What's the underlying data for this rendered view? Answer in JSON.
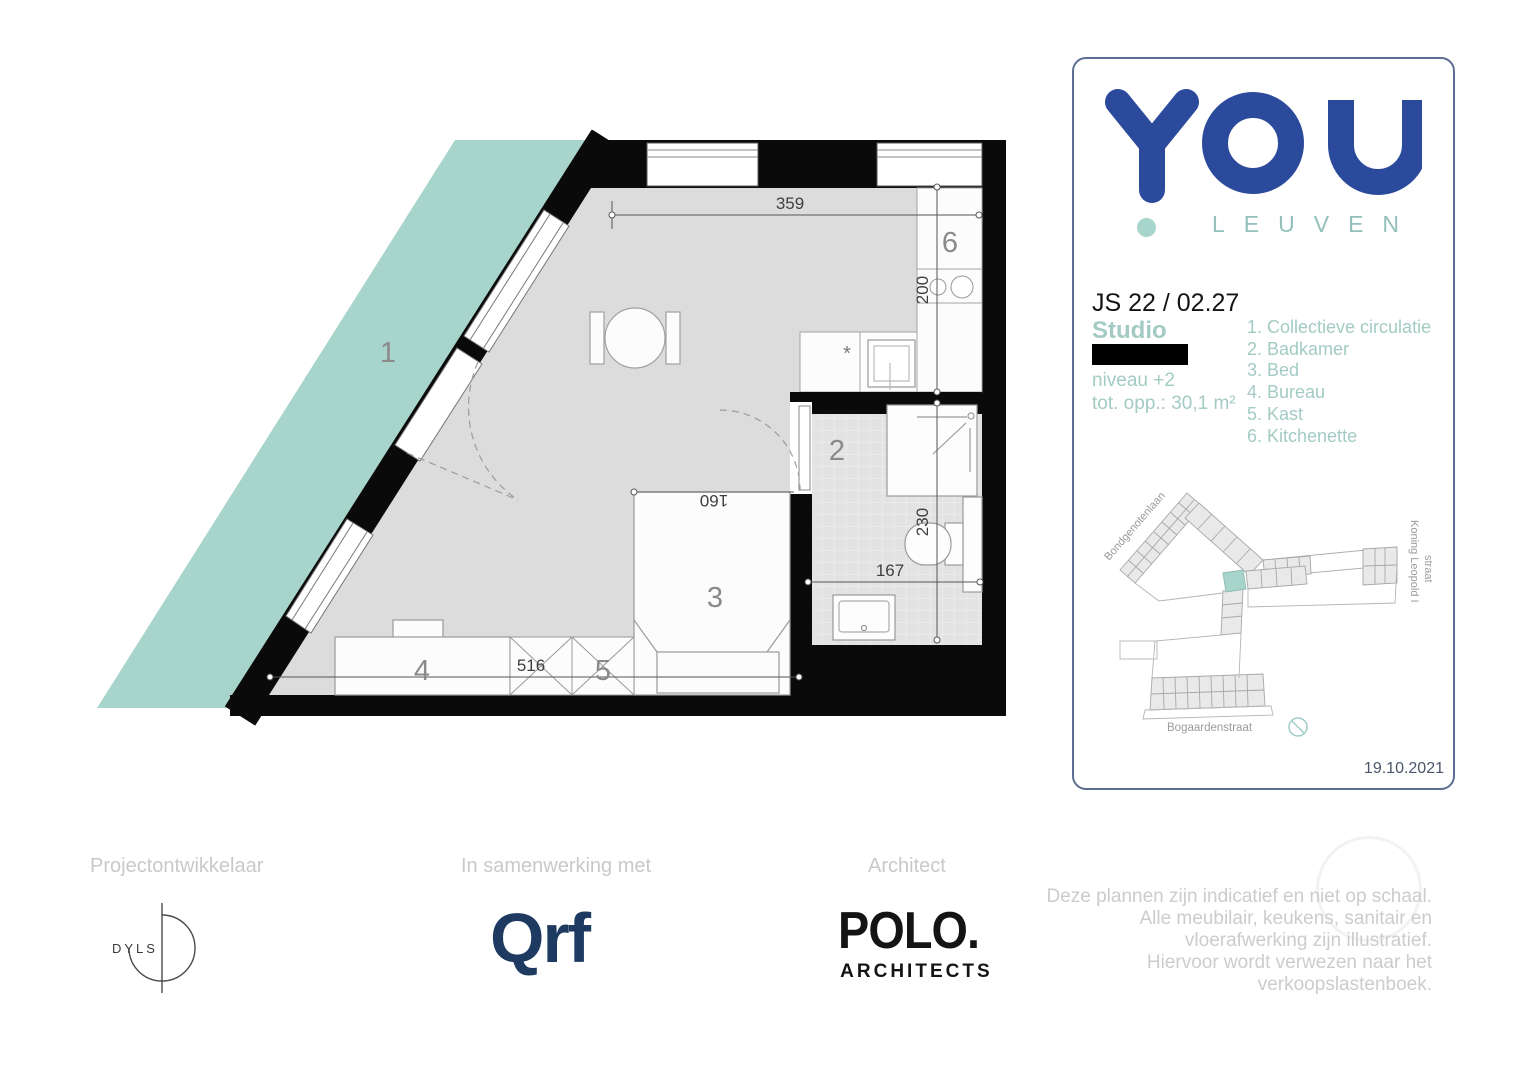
{
  "plan": {
    "rooms": {
      "circulation": "1",
      "bathroom": "2",
      "bed": "3",
      "bureau": "4",
      "kast": "5",
      "kitchenette": "6"
    },
    "dims": {
      "top": "359",
      "kitchen": "200",
      "bed": "160",
      "bath_v": "230",
      "bath_h": "167",
      "bottom": "516"
    },
    "kitchen_marker": "*",
    "colors": {
      "wall": "#0a0a0a",
      "floor": "#dcdcdc",
      "tile": "#e3e3e3",
      "circulation": "#a7d4cb"
    }
  },
  "card": {
    "logo": {
      "text": "YOU",
      "subtext": "LEUVEN",
      "blue": "#2b4a9c",
      "teal": "#a7d4cb"
    },
    "unit_code": "JS 22 / 02.27",
    "unit_type": "Studio",
    "level": "niveau +2",
    "area": "tot. opp.: 30,1 m²",
    "legend": [
      "1. Collectieve circulatie",
      "2. Badkamer",
      "3. Bed",
      "4. Bureau",
      "5. Kast",
      "6. Kitchenette"
    ],
    "map": {
      "street_nw": "Bondgenotenlaan",
      "street_e_line1": "Koning Leopold I",
      "street_e_line2": "straat",
      "street_s": "Bogaardenstraat"
    },
    "date": "19.10.2021"
  },
  "footer": {
    "developer_label": "Projectontwikkelaar",
    "partner_label": "In samenwerking met",
    "architect_label": "Architect",
    "developer_logo": "DYLS",
    "partner_logo": "Qrf",
    "architect_logo_line1": "POLO.",
    "architect_logo_line2": "ARCHITECTS",
    "disclaimer_lines": [
      "Deze plannen zijn indicatief en niet op schaal.",
      "Alle meubilair, keukens, sanitair en",
      "vloerafwerking zijn illustratief.",
      "Hiervoor wordt verwezen naar het",
      "verkoopslastenboek."
    ]
  }
}
